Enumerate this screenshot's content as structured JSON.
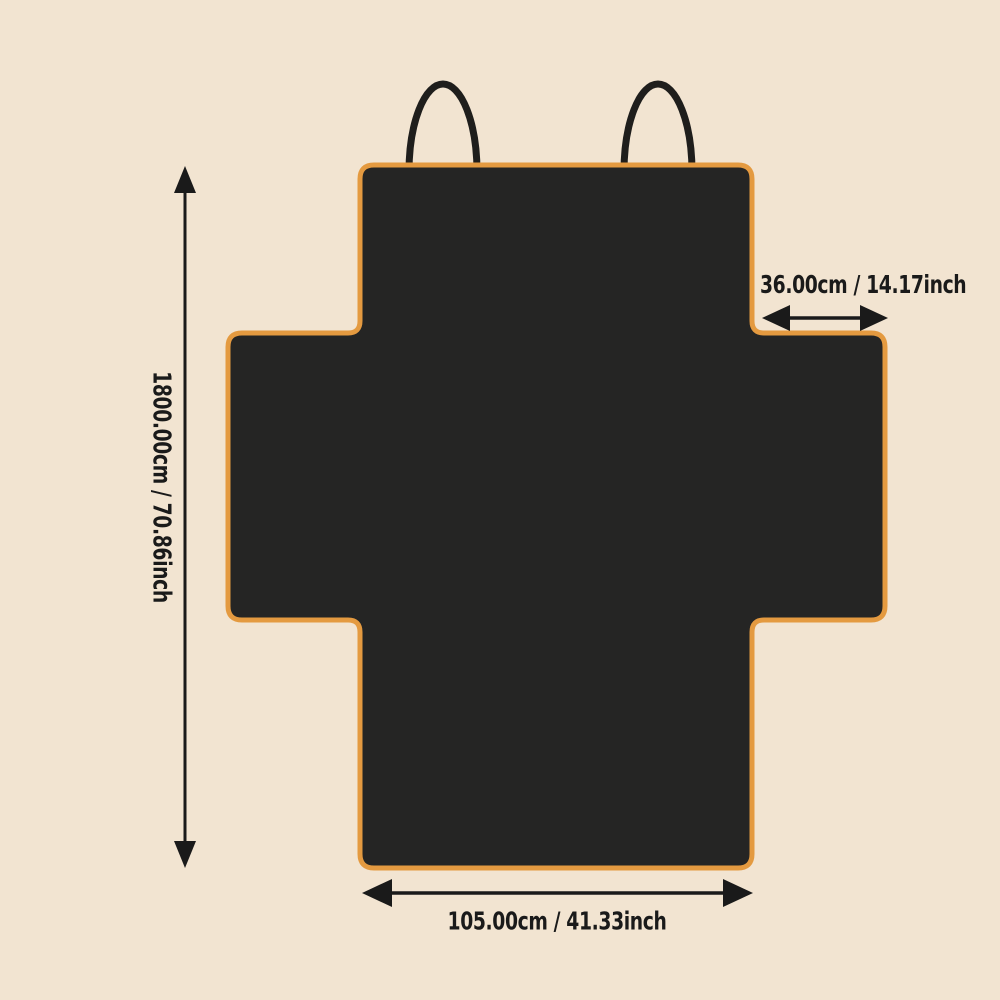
{
  "diagram": {
    "description_type": "product-dimension-diagram",
    "shape": "cross-shaped seat cover with two top hanging straps"
  },
  "dimensions": {
    "height": {
      "label": "1800.00cm / 70.86inch",
      "orientation": "vertical-left"
    },
    "side_flap_width": {
      "label": "36.00cm / 14.17inch",
      "orientation": "horizontal-top-right"
    },
    "bottom_width": {
      "label": "105.00cm / 41.33inch",
      "orientation": "horizontal-bottom"
    }
  },
  "colors": {
    "background": "#F2E4D1",
    "shape_fill": "#252524",
    "shape_border": "#E49A40",
    "strap": "#1F1E1C",
    "annotation": "#1A1A1A"
  },
  "icons": {
    "vertical_dimension_arrow": "double-headed vertical arrow (↕)",
    "side_flap_dimension_arrow": "double-headed horizontal arrow (↔)",
    "bottom_dimension_arrow": "double-headed horizontal arrow (↔)"
  }
}
